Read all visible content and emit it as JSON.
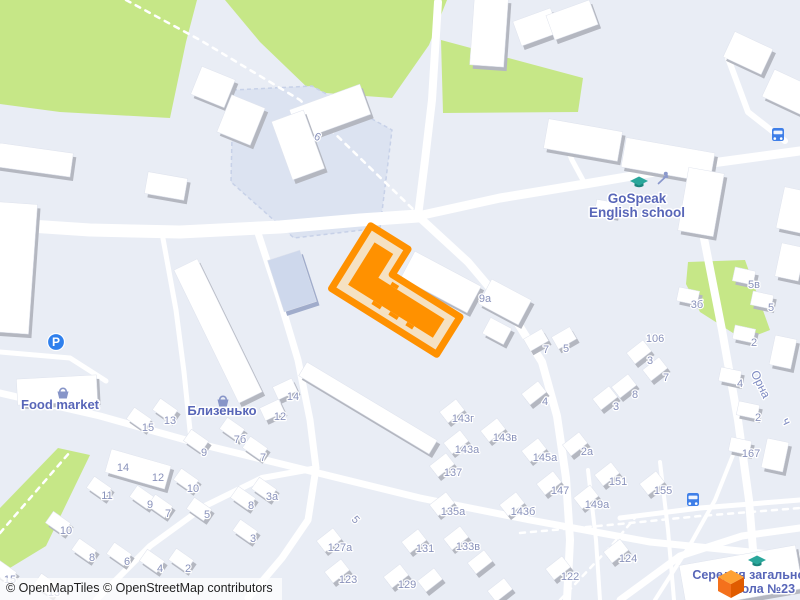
{
  "attribution": {
    "text": "© OpenMapTiles © OpenStreetMap contributors"
  },
  "colors": {
    "bg": "#e9edf5",
    "green": "#c6e787",
    "road": "#ffffff",
    "building": "#ffffff",
    "shadow": "#b4b7c0",
    "blue_building": "#ced8ec",
    "blue_building_shadow": "#a0accb",
    "courtyard": "#dce3f1",
    "courtyard_border": "#c7d1e8",
    "num_label": "#8992bb",
    "poi_label": "#5866b8",
    "street_label": "#7e8bc2",
    "school_icon": "#2aa79b",
    "school_icon_dark": "#1c857c",
    "parking": "#2f80ed",
    "bus": "#3f7fe8",
    "basket": "#8795c8",
    "playground": "#8a98cc",
    "highlight_stroke": "#ff9100",
    "highlight_fill": "#f5e1c2",
    "highlight_building": "#ff9100",
    "cube_top": "#ffa133",
    "cube_left": "#f4711c",
    "cube_right": "#e05c00"
  },
  "greens": [
    "0,0 197,0 186,42 170,118 60,112 0,104",
    "225,0 447,0 429,45 392,98 312,92 260,42",
    "441,40 583,78 578,112 443,113",
    "688,262 745,260 770,330 744,340 700,312 686,284",
    "58,448 90,455 46,546 0,574 0,508"
  ],
  "courtyards": [
    {
      "pts": "233,90 312,86 392,130 380,228 294,238 231,182"
    }
  ],
  "roads": [
    {
      "p": "0,224 90,230 180,232 280,227 360,220 418,216",
      "w": 13
    },
    {
      "p": "438,2 432,100 425,160 418,216",
      "w": 8
    },
    {
      "p": "418,216 500,198 585,184 690,166 800,151",
      "w": 9
    },
    {
      "p": "418,216 468,262 512,314 542,362 557,416 566,478 570,540 567,600",
      "w": 8
    },
    {
      "p": "258,233 280,300 298,360 310,420 316,468 308,520 282,558 248,598",
      "w": 7
    },
    {
      "p": "0,393 100,416 200,444 310,471 420,498 530,520 650,542 800,557",
      "w": 7
    },
    {
      "p": "96,600 150,546 205,506 262,478 312,469",
      "w": 6
    },
    {
      "p": "703,233 722,330 738,420 749,500 757,600",
      "w": 8
    },
    {
      "p": "620,600 680,556 742,536 800,528",
      "w": 7
    },
    {
      "p": "728,58 748,112 785,141",
      "w": 6
    },
    {
      "p": "0,352 70,358 106,381",
      "w": 5
    },
    {
      "p": "162,233 176,310 184,372 191,440",
      "w": 5
    },
    {
      "p": "560,130 572,160 585,184",
      "w": 5
    },
    {
      "p": "588,470 596,540 600,600",
      "w": 4
    },
    {
      "p": "660,462 668,530 674,600",
      "w": 4
    },
    {
      "p": "620,518 700,508 800,500",
      "w": 5
    },
    {
      "p": "655,600 690,545 715,500 735,450",
      "w": 4
    }
  ],
  "footpaths": [
    {
      "p": "126,0 200,40 300,100 418,214"
    },
    {
      "p": "0,533 70,452"
    },
    {
      "p": "520,533 620,524 700,516 800,508"
    },
    {
      "p": "560,600 612,545 640,512"
    }
  ],
  "buildings": [
    [
      14,
      268,
      38,
      130,
      4
    ],
    [
      57,
      390,
      80,
      26,
      -3
    ],
    [
      218,
      331,
      26,
      148,
      -26
    ],
    [
      330,
      112,
      75,
      32,
      -20
    ],
    [
      298,
      145,
      34,
      62,
      -20
    ],
    [
      213,
      87,
      36,
      30,
      22
    ],
    [
      241,
      120,
      36,
      40,
      22
    ],
    [
      35,
      160,
      74,
      24,
      8
    ],
    [
      166,
      186,
      40,
      22,
      10
    ],
    [
      489,
      32,
      34,
      68,
      4
    ],
    [
      536,
      27,
      40,
      26,
      -20
    ],
    [
      572,
      20,
      46,
      26,
      -20
    ],
    [
      583,
      140,
      75,
      30,
      10
    ],
    [
      668,
      160,
      90,
      30,
      10
    ],
    [
      701,
      202,
      36,
      64,
      10
    ],
    [
      748,
      53,
      42,
      28,
      25
    ],
    [
      790,
      93,
      48,
      30,
      25
    ],
    [
      441,
      282,
      75,
      30,
      28
    ],
    [
      505,
      302,
      45,
      28,
      28
    ],
    [
      497,
      331,
      24,
      18,
      28
    ],
    [
      368,
      408,
      152,
      16,
      31
    ],
    [
      741,
      577,
      118,
      44,
      -10
    ],
    [
      138,
      469,
      62,
      24,
      16
    ]
  ],
  "blue_buildings": [
    [
      292,
      281,
      34,
      54,
      -18
    ]
  ],
  "houses": [
    [
      139,
      419,
      35
    ],
    [
      165,
      410,
      35
    ],
    [
      232,
      429,
      35
    ],
    [
      255,
      448,
      35
    ],
    [
      196,
      441,
      35
    ],
    [
      186,
      480,
      35
    ],
    [
      99,
      488,
      35
    ],
    [
      142,
      497,
      35
    ],
    [
      160,
      506,
      35
    ],
    [
      199,
      509,
      35
    ],
    [
      243,
      498,
      35
    ],
    [
      264,
      489,
      35
    ],
    [
      58,
      523,
      35
    ],
    [
      245,
      531,
      35
    ],
    [
      84,
      550,
      35
    ],
    [
      119,
      554,
      35
    ],
    [
      152,
      561,
      35
    ],
    [
      181,
      560,
      35
    ],
    [
      4,
      572,
      35
    ],
    [
      46,
      585,
      35
    ],
    [
      285,
      389,
      -25
    ],
    [
      272,
      410,
      -25
    ],
    [
      452,
      411,
      -38
    ],
    [
      493,
      430,
      -38
    ],
    [
      456,
      442,
      -38
    ],
    [
      442,
      465,
      -38
    ],
    [
      534,
      450,
      -38
    ],
    [
      549,
      483,
      -38
    ],
    [
      442,
      504,
      -38
    ],
    [
      512,
      504,
      -38
    ],
    [
      586,
      497,
      -38
    ],
    [
      607,
      474,
      -38
    ],
    [
      652,
      483,
      -38
    ],
    [
      616,
      551,
      -38
    ],
    [
      558,
      568,
      -38
    ],
    [
      414,
      541,
      -38
    ],
    [
      456,
      538,
      -38
    ],
    [
      329,
      540,
      -38
    ],
    [
      337,
      571,
      -38
    ],
    [
      396,
      576,
      -38
    ],
    [
      575,
      444,
      -38
    ],
    [
      534,
      393,
      -38
    ],
    [
      639,
      352,
      -38
    ],
    [
      624,
      386,
      -38
    ],
    [
      605,
      398,
      -38
    ],
    [
      655,
      369,
      -38
    ],
    [
      536,
      340,
      -30
    ],
    [
      564,
      338,
      -30
    ],
    [
      480,
      562,
      -38
    ],
    [
      500,
      590,
      -38
    ],
    [
      430,
      580,
      -38
    ],
    [
      606,
      208,
      10
    ],
    [
      688,
      296,
      12
    ],
    [
      744,
      276,
      12
    ],
    [
      762,
      300,
      12
    ],
    [
      744,
      334,
      12
    ],
    [
      730,
      376,
      12
    ],
    [
      748,
      410,
      12
    ],
    [
      740,
      446,
      12
    ],
    [
      793,
      210,
      12,
      26,
      42
    ],
    [
      790,
      262,
      12,
      24,
      34
    ],
    [
      783,
      352,
      12,
      22,
      30
    ],
    [
      775,
      455,
      12,
      22,
      30
    ]
  ],
  "highlight": {
    "cx": 400,
    "cy": 296,
    "rot": 32,
    "outer": "-62,-44 -18,-44 -18,-14 62,-14 62,30 -62,30",
    "inner": "-50,-32 -28,-32 -28,-4 50,-4 50,18 -50,18",
    "bumps": [
      [
        -20,
        18,
        10,
        4
      ],
      [
        0,
        18,
        10,
        4
      ],
      [
        20,
        18,
        8,
        4
      ],
      [
        -14,
        -8,
        8,
        4
      ]
    ]
  },
  "house_numbers": [
    {
      "t": "6",
      "x": 316,
      "y": 140,
      "r": 25
    },
    {
      "t": "9а",
      "x": 485,
      "y": 302
    },
    {
      "t": "7",
      "x": 546,
      "y": 353
    },
    {
      "t": "5",
      "x": 566,
      "y": 352
    },
    {
      "t": "106",
      "x": 655,
      "y": 342
    },
    {
      "t": "3",
      "x": 650,
      "y": 364
    },
    {
      "t": "7",
      "x": 666,
      "y": 381
    },
    {
      "t": "8",
      "x": 635,
      "y": 398
    },
    {
      "t": "3",
      "x": 616,
      "y": 410
    },
    {
      "t": "4",
      "x": 545,
      "y": 405
    },
    {
      "t": "3б",
      "x": 697,
      "y": 308
    },
    {
      "t": "5в",
      "x": 754,
      "y": 288
    },
    {
      "t": "5",
      "x": 771,
      "y": 311
    },
    {
      "t": "2",
      "x": 754,
      "y": 346
    },
    {
      "t": "4",
      "x": 740,
      "y": 387
    },
    {
      "t": "2",
      "x": 758,
      "y": 421
    },
    {
      "t": "167",
      "x": 751,
      "y": 457
    },
    {
      "t": "143г",
      "x": 463,
      "y": 422
    },
    {
      "t": "143в",
      "x": 505,
      "y": 441
    },
    {
      "t": "143а",
      "x": 467,
      "y": 453
    },
    {
      "t": "137",
      "x": 453,
      "y": 476
    },
    {
      "t": "145а",
      "x": 545,
      "y": 461
    },
    {
      "t": "2а",
      "x": 587,
      "y": 455
    },
    {
      "t": "147",
      "x": 560,
      "y": 494
    },
    {
      "t": "135а",
      "x": 453,
      "y": 515
    },
    {
      "t": "143б",
      "x": 523,
      "y": 515
    },
    {
      "t": "149а",
      "x": 597,
      "y": 508
    },
    {
      "t": "151",
      "x": 618,
      "y": 485
    },
    {
      "t": "155",
      "x": 663,
      "y": 494
    },
    {
      "t": "124",
      "x": 628,
      "y": 562
    },
    {
      "t": "122",
      "x": 570,
      "y": 580
    },
    {
      "t": "131",
      "x": 425,
      "y": 552
    },
    {
      "t": "133в",
      "x": 468,
      "y": 550
    },
    {
      "t": "127а",
      "x": 340,
      "y": 551
    },
    {
      "t": "123",
      "x": 348,
      "y": 583
    },
    {
      "t": "129",
      "x": 407,
      "y": 588
    },
    {
      "t": "5",
      "x": 353,
      "y": 522,
      "r": 48
    },
    {
      "t": "15",
      "x": 148,
      "y": 431
    },
    {
      "t": "13",
      "x": 170,
      "y": 424
    },
    {
      "t": "7б",
      "x": 240,
      "y": 443
    },
    {
      "t": "9",
      "x": 204,
      "y": 456
    },
    {
      "t": "7",
      "x": 263,
      "y": 461
    },
    {
      "t": "14",
      "x": 123,
      "y": 471
    },
    {
      "t": "12",
      "x": 158,
      "y": 481
    },
    {
      "t": "10",
      "x": 193,
      "y": 492
    },
    {
      "t": "11",
      "x": 107,
      "y": 499
    },
    {
      "t": "9",
      "x": 150,
      "y": 508
    },
    {
      "t": "7",
      "x": 168,
      "y": 517
    },
    {
      "t": "5",
      "x": 207,
      "y": 518
    },
    {
      "t": "8",
      "x": 251,
      "y": 509
    },
    {
      "t": "3а",
      "x": 272,
      "y": 500
    },
    {
      "t": "10",
      "x": 66,
      "y": 534
    },
    {
      "t": "3",
      "x": 253,
      "y": 542
    },
    {
      "t": "8",
      "x": 92,
      "y": 561
    },
    {
      "t": "6",
      "x": 127,
      "y": 565
    },
    {
      "t": "4",
      "x": 160,
      "y": 572
    },
    {
      "t": "2",
      "x": 188,
      "y": 572
    },
    {
      "t": "15",
      "x": 10,
      "y": 583
    },
    {
      "t": "13",
      "x": 54,
      "y": 596
    },
    {
      "t": "14",
      "x": 293,
      "y": 400
    },
    {
      "t": "12",
      "x": 280,
      "y": 420
    }
  ],
  "street_labels": [
    {
      "t": "Орна",
      "x": 757,
      "y": 386,
      "r": 64
    },
    {
      "t": "ч",
      "x": 783,
      "y": 423,
      "r": 64
    }
  ],
  "pois": {
    "gospeak": {
      "lines": [
        "GoSpeak",
        "English school"
      ],
      "x": 637,
      "y": 203,
      "lh": 14
    },
    "food_market": {
      "t": "Food market",
      "x": 60,
      "y": 409
    },
    "blyzenko": {
      "t": "Близенько",
      "x": 222,
      "y": 415
    },
    "school23": {
      "lines": [
        "Середня загальноосвітня",
        "школа №23"
      ],
      "x": [
        772,
        760
      ],
      "y": [
        579,
        593
      ]
    }
  },
  "icons": {
    "parking": [
      56,
      342
    ],
    "buses": [
      [
        778,
        135
      ],
      [
        693,
        500
      ]
    ],
    "school_caps": [
      [
        639,
        183
      ],
      [
        757,
        562
      ]
    ],
    "baskets": [
      [
        63,
        393
      ],
      [
        223,
        401
      ]
    ],
    "playground": [
      663,
      179
    ]
  },
  "marker": {
    "x": 731,
    "y": 584
  }
}
